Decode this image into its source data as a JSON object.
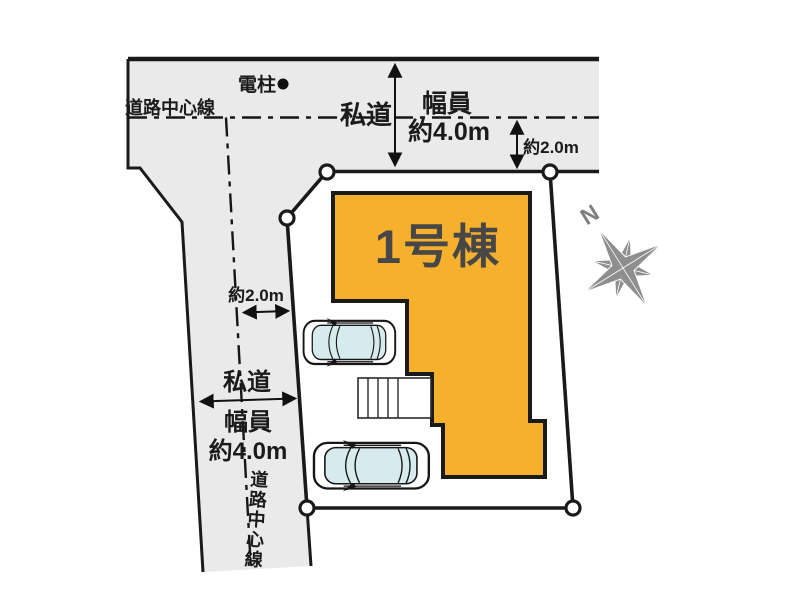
{
  "colors": {
    "road_fill": "#EAEAEA",
    "building_fill": "#F5B02E",
    "car_glass": "#D7EAEE",
    "compass_gray": "#8E8E8E",
    "line": "#1A1A1A"
  },
  "building": {
    "label": "1号棟"
  },
  "compass": {
    "north_label": "N"
  },
  "top_road": {
    "pole_label": "電柱",
    "centerline_label": "道路中心線",
    "road_label": "私道",
    "width_label": "幅員",
    "width_value": "約4.0m",
    "half_width_value": "約2.0m"
  },
  "left_road": {
    "half_width_value": "約2.0m",
    "road_label": "私道",
    "width_label": "幅員",
    "width_value": "約4.0m",
    "centerline_label": "道路中心線"
  }
}
